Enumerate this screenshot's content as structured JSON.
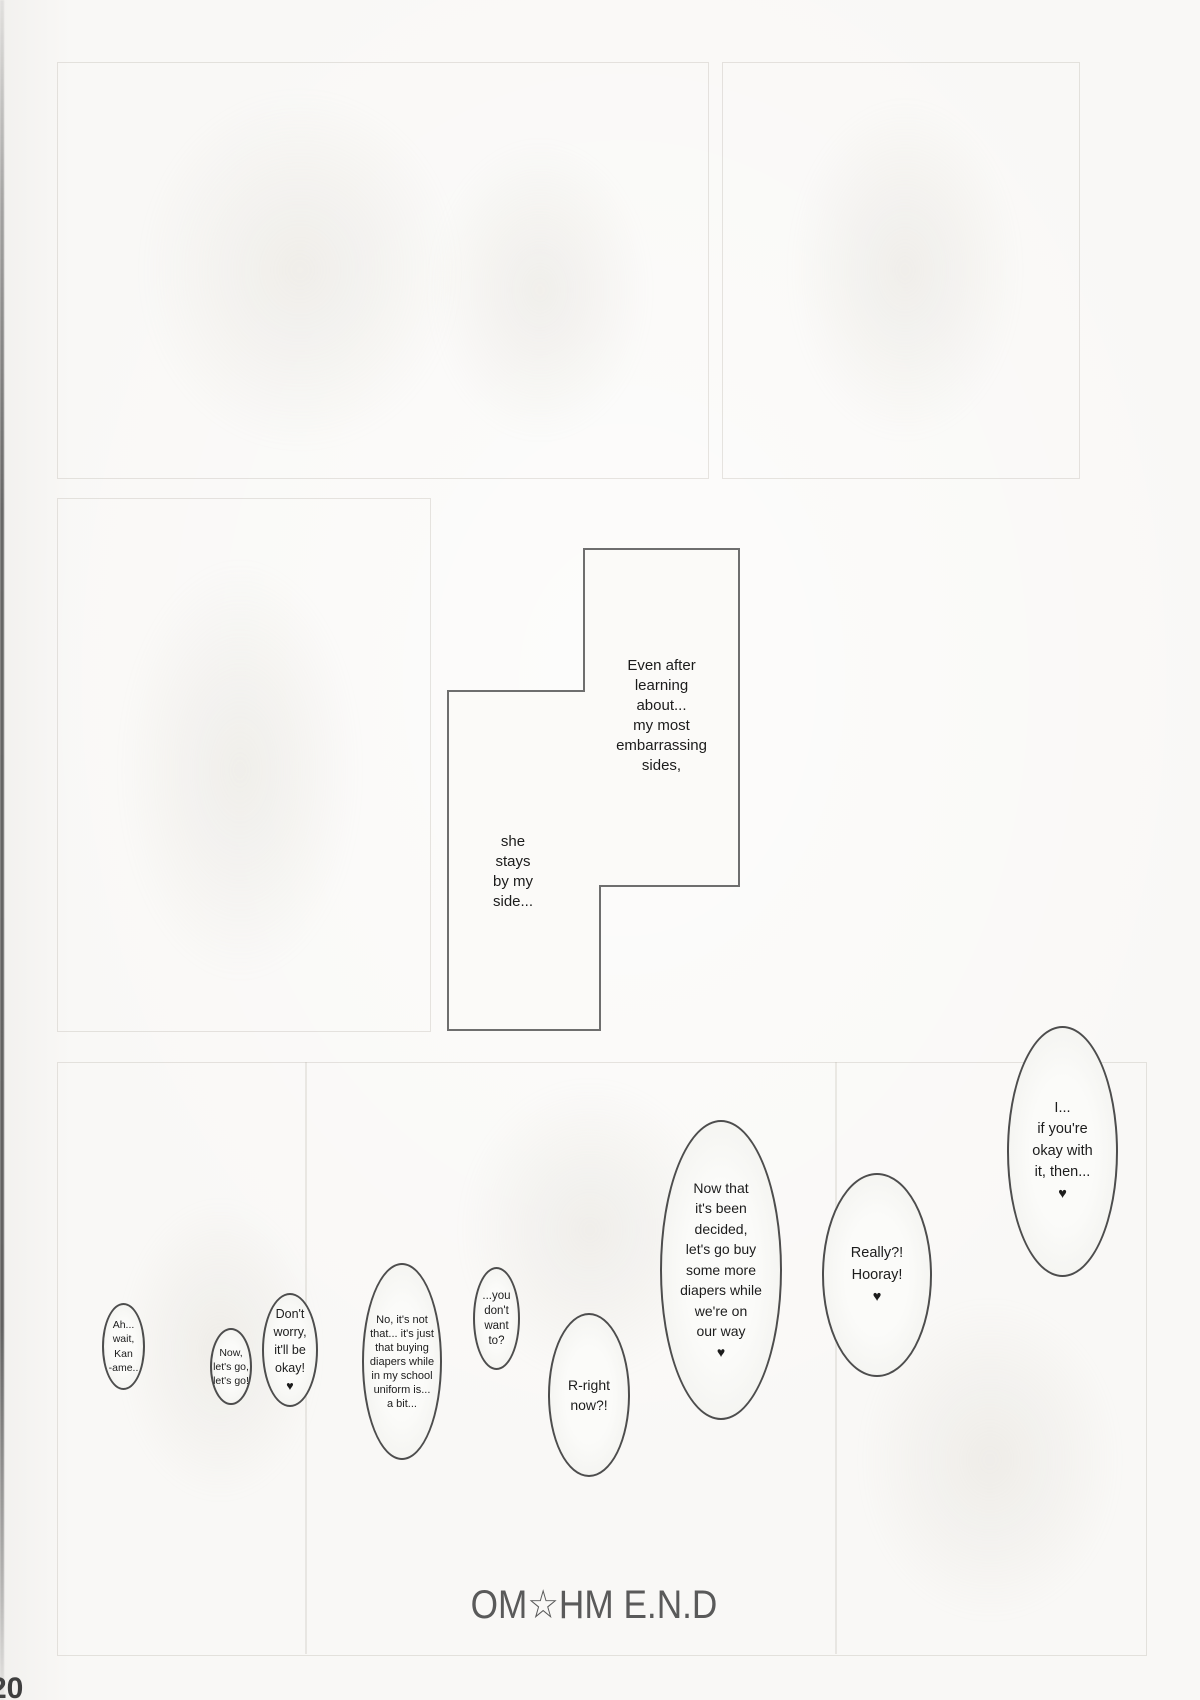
{
  "page": {
    "number": "20",
    "end_mark": "OM☆HM E.N.D",
    "colors": {
      "paper": "#f9f8f6",
      "ink": "#1c1c1c",
      "bubble_outline": "#4d4d4d",
      "caption_outline": "#6e6e6e",
      "end_mark": "#5a5a5a",
      "page_number": "#3f3f3f"
    }
  },
  "captions": {
    "part1": "Even after\nlearning\nabout...\nmy most\nembarrassing\nsides,",
    "part2": "she\nstays\nby my\nside..."
  },
  "bubbles": [
    {
      "id": "bubble-ah-wait",
      "text": "Ah...\nwait,\nKan\n-ame.."
    },
    {
      "id": "bubble-lets-go",
      "text": "Now,\nlet's go,\nlet's go!"
    },
    {
      "id": "bubble-dont-worry",
      "text": "Don't\nworry,\nit'll be\nokay!\n♥"
    },
    {
      "id": "bubble-no-its-not",
      "text": "No, it's not\nthat... it's just\nthat buying\ndiapers while\nin my school\nuniform is...\na bit..."
    },
    {
      "id": "bubble-you-dont-want",
      "text": "...you\ndon't\nwant\nto?"
    },
    {
      "id": "bubble-r-right-now",
      "text": "R-right\nnow?!"
    },
    {
      "id": "bubble-now-that",
      "text": "Now that\nit's been\ndecided,\nlet's go buy\nsome more\ndiapers while\nwe're on\nour way\n♥"
    },
    {
      "id": "bubble-really-hooray",
      "text": "Really?!\nHooray!\n♥"
    },
    {
      "id": "bubble-if-youre-okay",
      "text": "I...\nif you're\nokay with\nit, then...\n♥"
    }
  ]
}
